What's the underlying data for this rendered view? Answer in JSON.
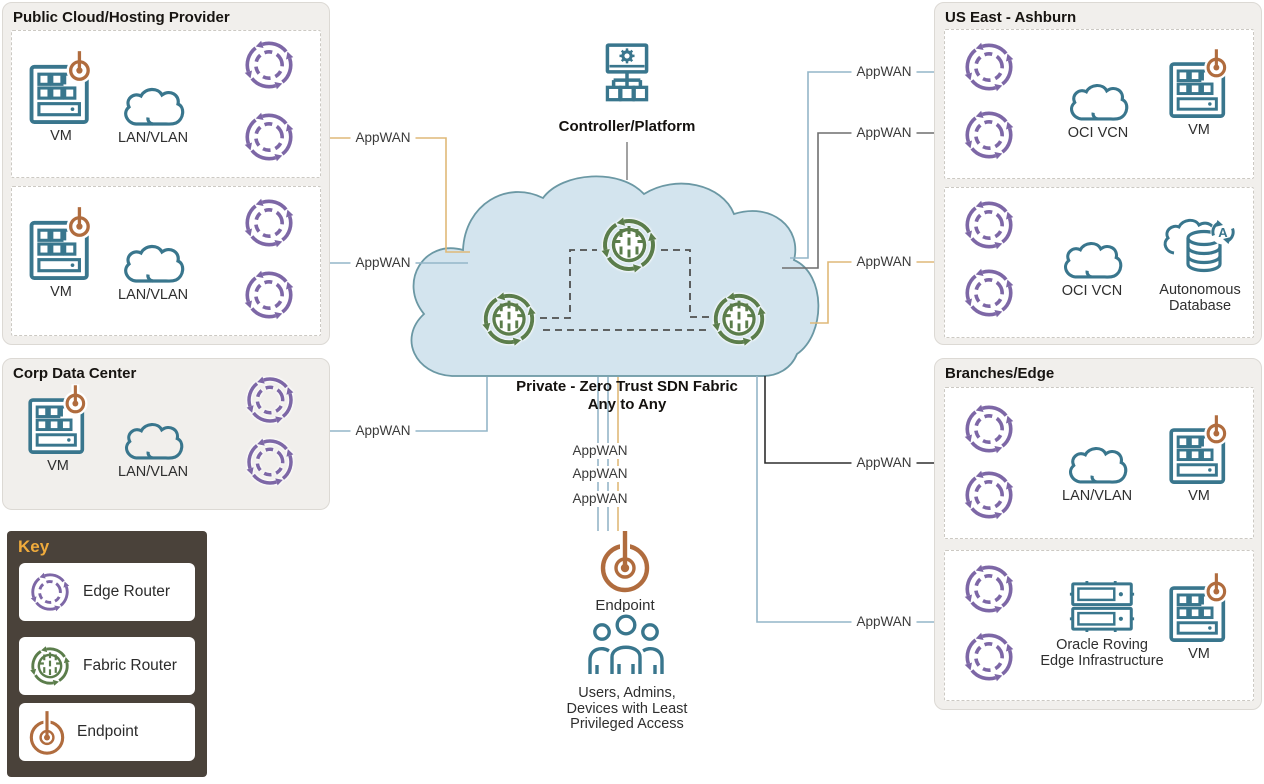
{
  "appwan_label": "AppWAN",
  "groups": {
    "public_cloud": {
      "title": "Public Cloud/Hosting Provider"
    },
    "corp_dc": {
      "title": "Corp Data Center"
    },
    "us_east": {
      "title": "US East - Ashburn"
    },
    "branches": {
      "title": "Branches/Edge"
    }
  },
  "node_labels": {
    "vm": "VM",
    "lan_vlan": "LAN/VLAN",
    "oci_vcn": "OCI VCN",
    "autonomous_db_1": "Autonomous",
    "autonomous_db_2": "Database",
    "roving_1": "Oracle Roving",
    "roving_2": "Edge Infrastructure"
  },
  "center": {
    "controller_label": "Controller/Platform",
    "fabric_title_1": "Private - Zero Trust SDN Fabric",
    "fabric_title_2": "Any to Any",
    "endpoint_label": "Endpoint",
    "users_caption_1": "Users, Admins,",
    "users_caption_2": "Devices with Least",
    "users_caption_3": "Privileged Access"
  },
  "key": {
    "title": "Key",
    "items": [
      {
        "label": "Edge Router"
      },
      {
        "label": "Fabric Router"
      },
      {
        "label": "Endpoint"
      }
    ]
  },
  "colors": {
    "edge_router": "#7d67a6",
    "fabric_router": "#5b7d4b",
    "endpoint": "#b06c3e",
    "node_teal": "#39768d",
    "cloud_fill": "#d3e4ee",
    "cloud_stroke": "#6b98a4",
    "line_gold": "#dfb978",
    "line_blue": "#94b6c8",
    "line_gray": "#6f6f6f",
    "line_dark": "#2e2e2e",
    "box_bg": "#f1efec",
    "key_bg": "#4a423a",
    "key_title": "#f0ab3c"
  }
}
